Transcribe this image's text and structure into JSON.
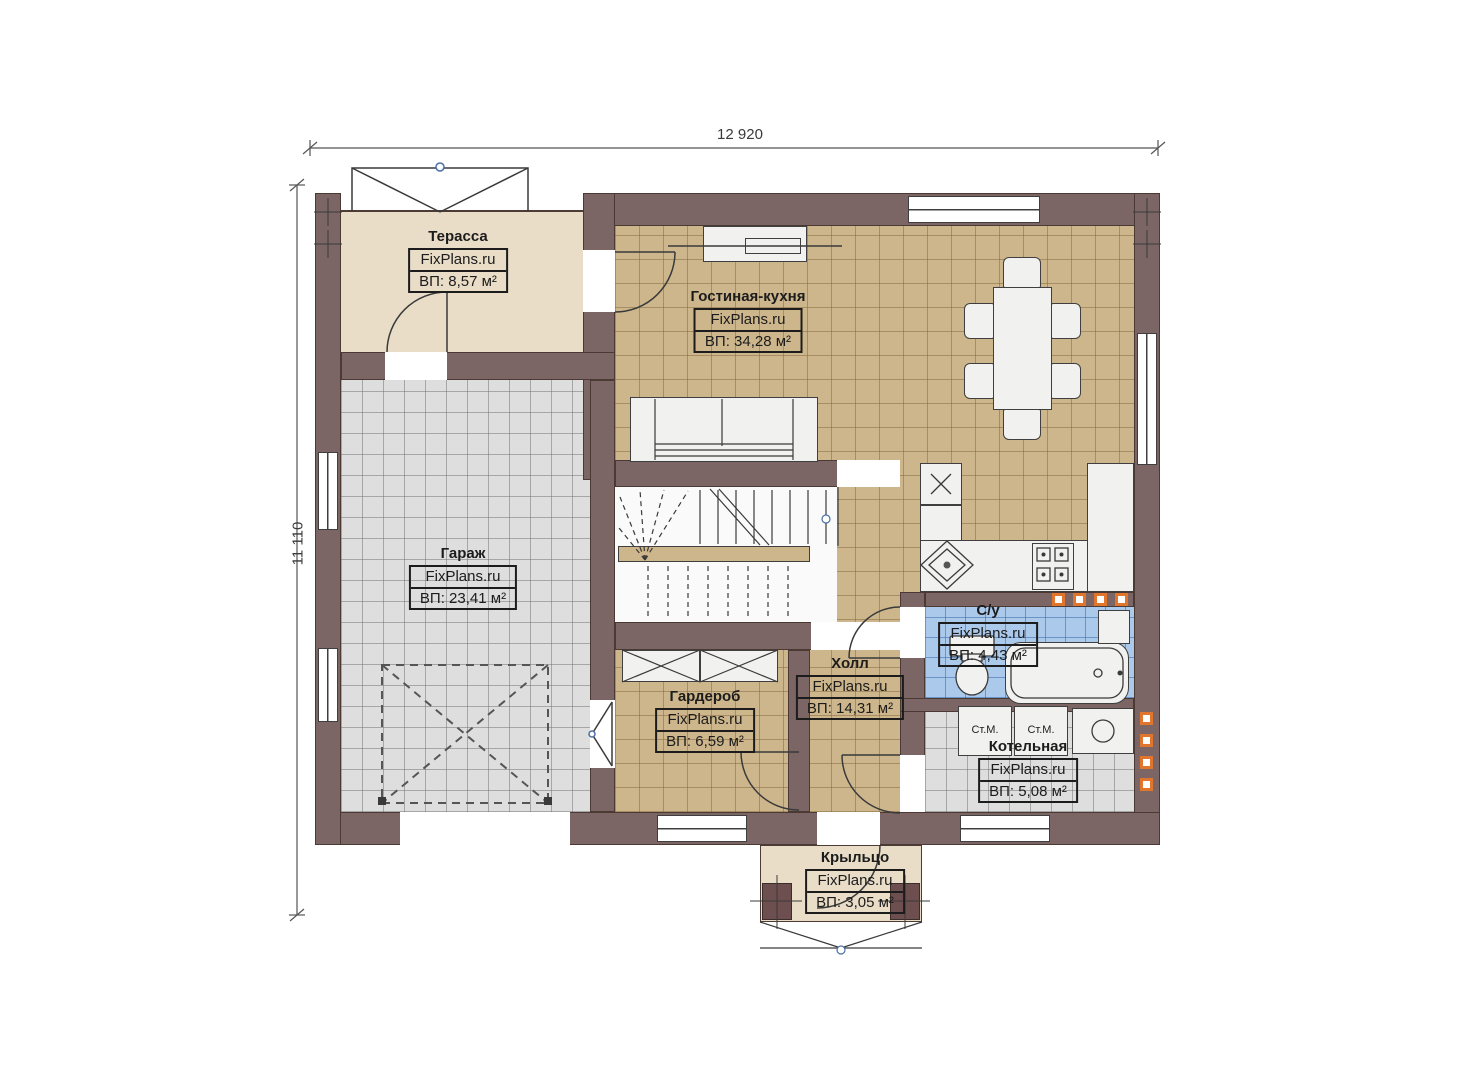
{
  "plan": {
    "dimensions": {
      "width_label": "12 920",
      "height_label": "11 110"
    },
    "brand": "FixPlans.ru",
    "rooms": [
      {
        "id": "terrace",
        "name": "Терасса",
        "area_label": "ВП: 8,57 м²"
      },
      {
        "id": "living-kitchen",
        "name": "Гостиная-кухня",
        "area_label": "ВП: 34,28 м²"
      },
      {
        "id": "garage",
        "name": "Гараж",
        "area_label": "ВП: 23,41 м²"
      },
      {
        "id": "wardrobe",
        "name": "Гардероб",
        "area_label": "ВП: 6,59 м²"
      },
      {
        "id": "hall",
        "name": "Холл",
        "area_label": "ВП: 14,31 м²"
      },
      {
        "id": "bathroom",
        "name": "С/у",
        "area_label": "ВП: 4,43 м²"
      },
      {
        "id": "boiler",
        "name": "Котельная",
        "area_label": "ВП: 5,08 м²"
      },
      {
        "id": "porch",
        "name": "Крыльцо",
        "area_label": "ВП: 3,05 м²"
      }
    ],
    "appliances": {
      "washer_1": "Ст.М.",
      "washer_2": "Ст.М."
    },
    "colors": {
      "wall": "#7b6565",
      "floor_tile_tan": "#cdb68c",
      "floor_tile_gray": "#dedede",
      "floor_tile_blue": "#abc9eb",
      "terrace_beige": "#e9ddc8",
      "accent_orange": "#e0762e",
      "line": "#3a3a3a"
    }
  }
}
